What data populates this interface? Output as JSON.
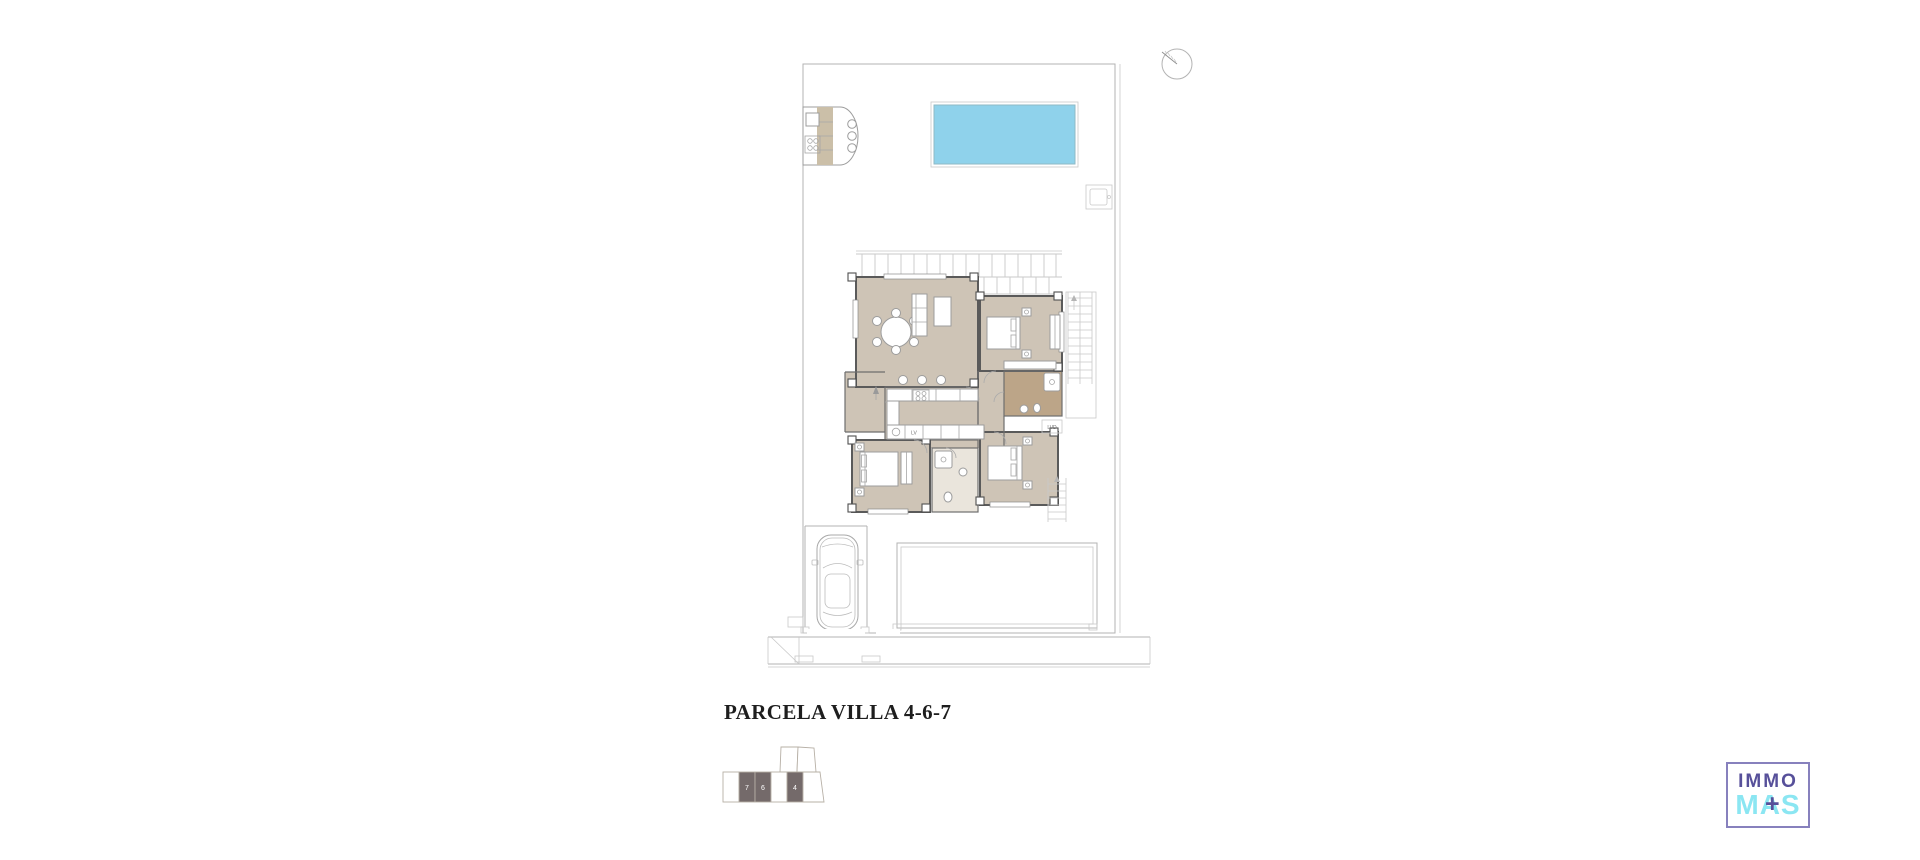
{
  "title": "PARCELA VILLA 4-6-7",
  "plan": {
    "labels": {
      "dishwasher": "LV",
      "laundry": "LVD"
    }
  },
  "key_plan": {
    "units": [
      "7",
      "6",
      "4"
    ]
  },
  "logo": {
    "top": "IMMO",
    "bottom": "MAS",
    "plus": "+"
  },
  "icons": {
    "north_arrow": "compass-circle-with-needle",
    "car": "car-top-view"
  },
  "colors": {
    "pool_fill": "#8FD2EB",
    "pool_border": "#8FB9C6",
    "floor_main": "#CEC4B6",
    "floor_bath": "#BCA588",
    "floor_bath_small": "#EAE5DC",
    "outdoor_counter": "#CBBFA8",
    "keyplan_fill": "#746A6A",
    "logo_purple": "#57509A",
    "logo_cyan": "#8BE6F2",
    "logo_border": "#8781BD"
  }
}
